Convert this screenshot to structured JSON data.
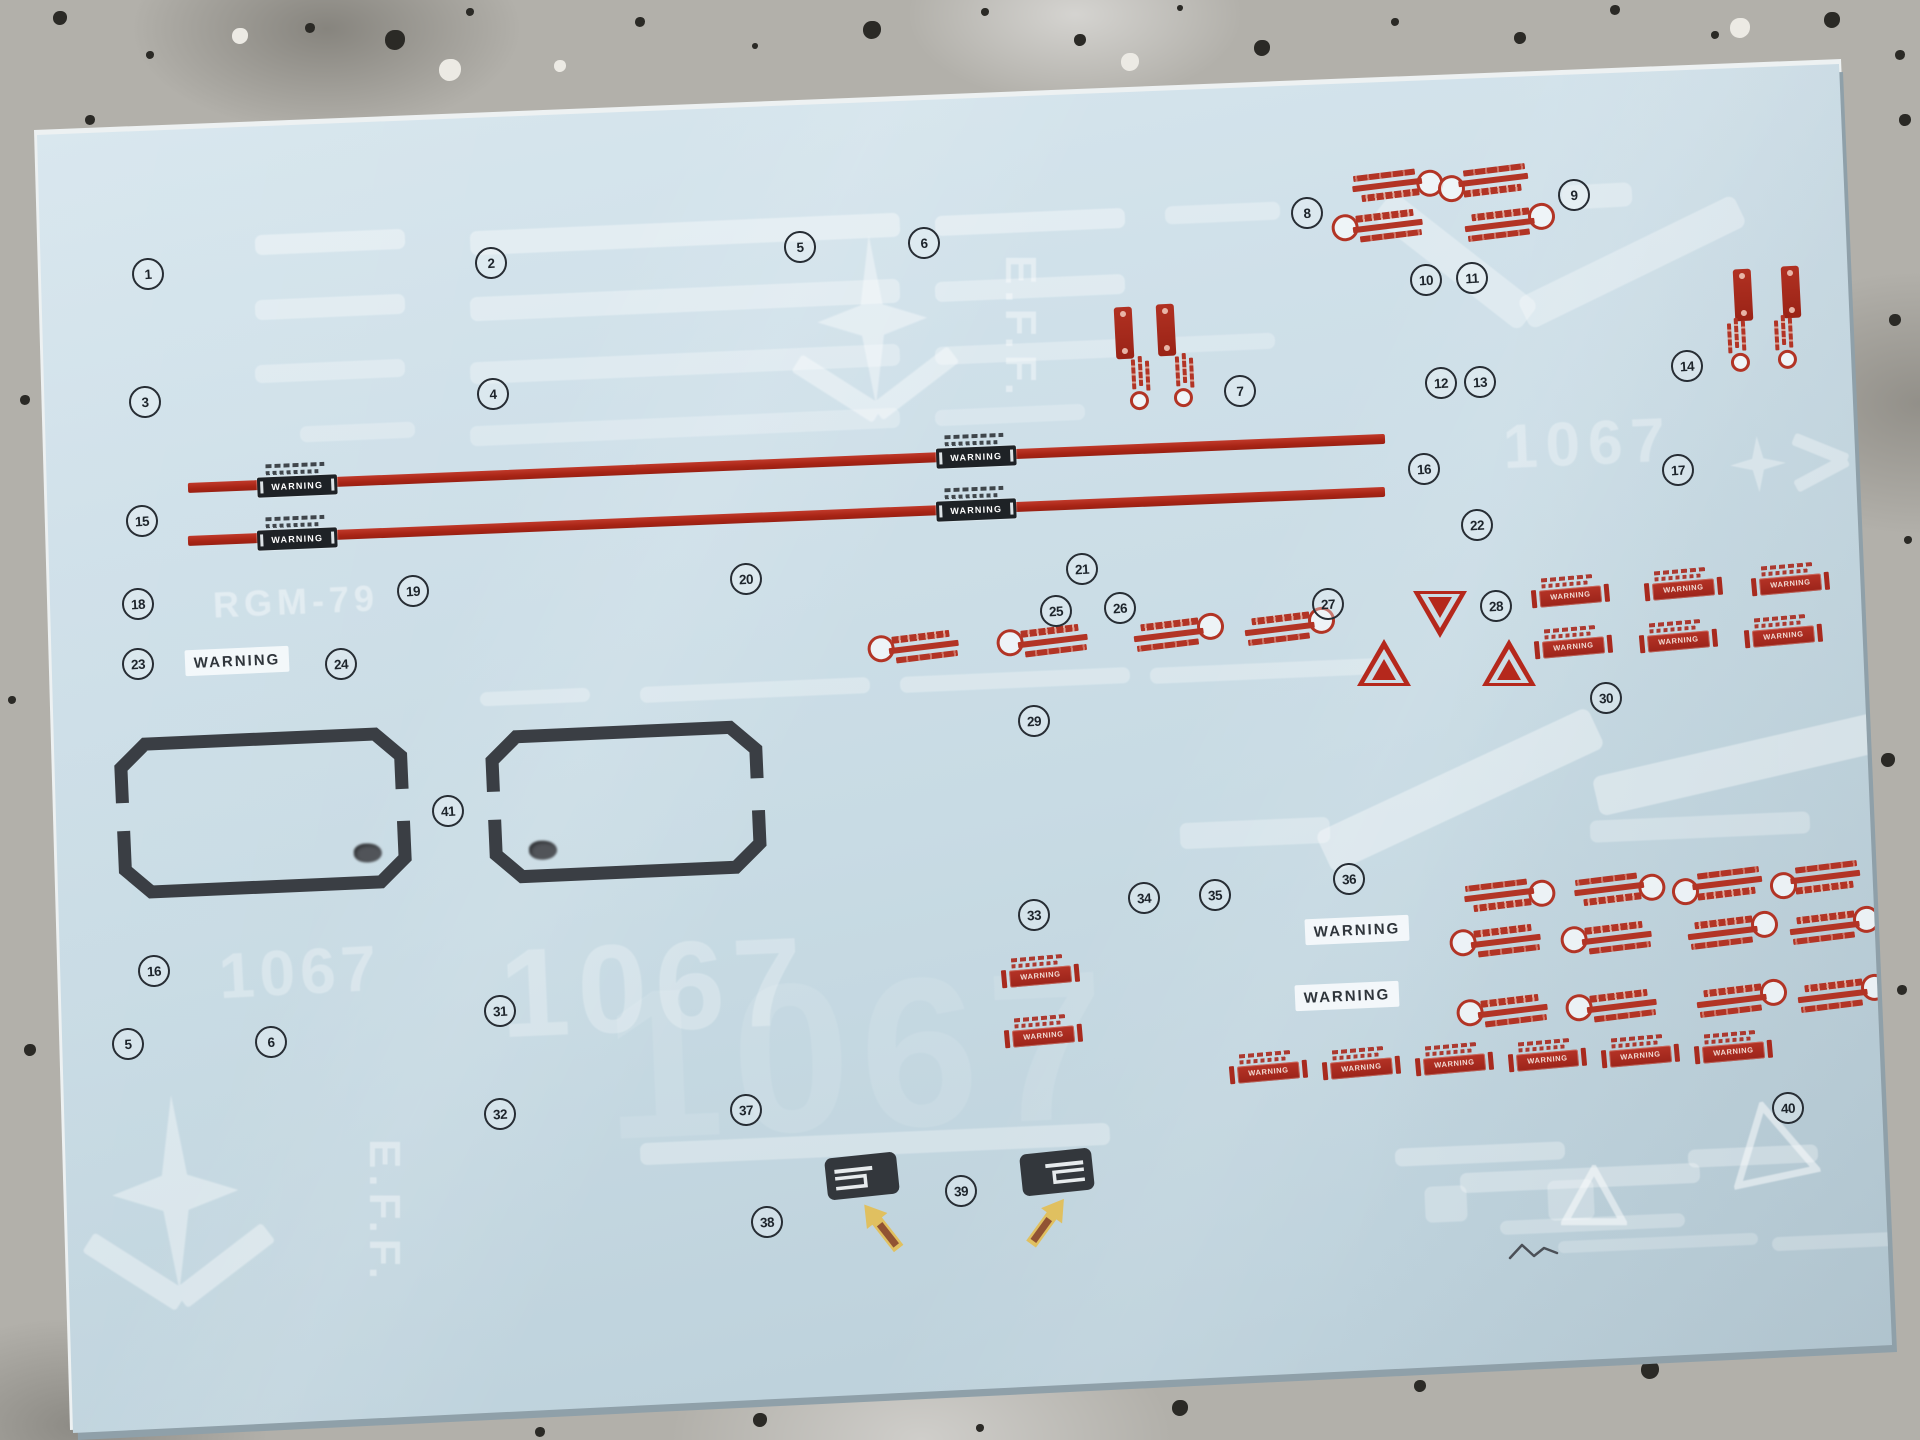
{
  "labels": {
    "warning": "WARNING",
    "eff": "E.F.F.",
    "model_code": "RGM-79",
    "unit_number": "1067"
  },
  "colors": {
    "sheet_blue": "#cbdde6",
    "decal_red": "#b23425",
    "decal_dark": "#33373c",
    "arrow_yellow": "#e2bf5a"
  },
  "markers": [
    {
      "n": "1",
      "x": 146,
      "y": 272
    },
    {
      "n": "2",
      "x": 489,
      "y": 261
    },
    {
      "n": "3",
      "x": 143,
      "y": 400
    },
    {
      "n": "4",
      "x": 491,
      "y": 392
    },
    {
      "n": "5",
      "x": 798,
      "y": 245
    },
    {
      "n": "6",
      "x": 922,
      "y": 241
    },
    {
      "n": "7",
      "x": 1238,
      "y": 389
    },
    {
      "n": "8",
      "x": 1305,
      "y": 211
    },
    {
      "n": "9",
      "x": 1572,
      "y": 193
    },
    {
      "n": "10",
      "x": 1424,
      "y": 278
    },
    {
      "n": "11",
      "x": 1470,
      "y": 276
    },
    {
      "n": "12",
      "x": 1439,
      "y": 381
    },
    {
      "n": "13",
      "x": 1478,
      "y": 380
    },
    {
      "n": "14",
      "x": 1685,
      "y": 364
    },
    {
      "n": "15",
      "x": 140,
      "y": 519
    },
    {
      "n": "16",
      "x": 1422,
      "y": 467
    },
    {
      "n": "17",
      "x": 1676,
      "y": 468
    },
    {
      "n": "18",
      "x": 136,
      "y": 602
    },
    {
      "n": "19",
      "x": 411,
      "y": 589
    },
    {
      "n": "20",
      "x": 744,
      "y": 577
    },
    {
      "n": "21",
      "x": 1080,
      "y": 567
    },
    {
      "n": "22",
      "x": 1475,
      "y": 523
    },
    {
      "n": "23",
      "x": 136,
      "y": 662
    },
    {
      "n": "24",
      "x": 339,
      "y": 662
    },
    {
      "n": "25",
      "x": 1054,
      "y": 609
    },
    {
      "n": "26",
      "x": 1118,
      "y": 606
    },
    {
      "n": "27",
      "x": 1326,
      "y": 602
    },
    {
      "n": "28",
      "x": 1494,
      "y": 604
    },
    {
      "n": "29",
      "x": 1032,
      "y": 719
    },
    {
      "n": "30",
      "x": 1604,
      "y": 696
    },
    {
      "n": "31",
      "x": 498,
      "y": 1009
    },
    {
      "n": "32",
      "x": 498,
      "y": 1112
    },
    {
      "n": "33",
      "x": 1032,
      "y": 913
    },
    {
      "n": "34",
      "x": 1142,
      "y": 896
    },
    {
      "n": "35",
      "x": 1213,
      "y": 893
    },
    {
      "n": "36",
      "x": 1347,
      "y": 877
    },
    {
      "n": "37",
      "x": 744,
      "y": 1108
    },
    {
      "n": "38",
      "x": 765,
      "y": 1220
    },
    {
      "n": "39",
      "x": 959,
      "y": 1189
    },
    {
      "n": "40",
      "x": 1786,
      "y": 1106
    },
    {
      "n": "41",
      "x": 446,
      "y": 809
    },
    {
      "n": "16",
      "x": 152,
      "y": 969
    },
    {
      "n": "5",
      "x": 126,
      "y": 1042
    },
    {
      "n": "6",
      "x": 269,
      "y": 1040
    }
  ],
  "red_stripes": [
    [
      188,
      488,
      1198
    ],
    [
      188,
      541,
      1198
    ]
  ],
  "stripe_warning_labels": [
    [
      297,
      481
    ],
    [
      976,
      452
    ],
    [
      297,
      534
    ],
    [
      976,
      505
    ]
  ],
  "white_warning_boxes": [
    [
      237,
      661
    ],
    [
      1357,
      930
    ],
    [
      1347,
      996
    ]
  ],
  "red_warning_boxes": [
    [
      1570,
      592
    ],
    [
      1683,
      585
    ],
    [
      1790,
      580
    ],
    [
      1573,
      643
    ],
    [
      1678,
      637
    ],
    [
      1783,
      632
    ],
    [
      1040,
      972
    ],
    [
      1043,
      1032
    ],
    [
      1268,
      1068
    ],
    [
      1361,
      1064
    ],
    [
      1454,
      1060
    ],
    [
      1547,
      1056
    ],
    [
      1640,
      1052
    ],
    [
      1733,
      1048
    ]
  ],
  "armor_lock_decals": [
    [
      924,
      649,
      "tl"
    ],
    [
      1053,
      643,
      "tl"
    ],
    [
      1169,
      637,
      "tr"
    ],
    [
      1280,
      631,
      "tr"
    ],
    [
      1387,
      183,
      "br"
    ],
    [
      1493,
      178,
      "bl"
    ],
    [
      1388,
      228,
      "tl"
    ],
    [
      1500,
      227,
      "tr"
    ],
    [
      1499,
      893,
      "br"
    ],
    [
      1609,
      887,
      "br"
    ],
    [
      1727,
      881,
      "bl"
    ],
    [
      1825,
      875,
      "bl"
    ],
    [
      1506,
      943,
      "tl"
    ],
    [
      1617,
      940,
      "tl"
    ],
    [
      1723,
      935,
      "tr"
    ],
    [
      1825,
      930,
      "tr"
    ],
    [
      1513,
      1013,
      "tl"
    ],
    [
      1622,
      1008,
      "tl"
    ],
    [
      1732,
      1003,
      "tr"
    ],
    [
      1833,
      998,
      "tr"
    ]
  ],
  "red_pill_decals": [
    [
      1124,
      333
    ],
    [
      1166,
      330
    ],
    [
      1743,
      295
    ],
    [
      1791,
      292
    ]
  ],
  "vertical_lock_decals": [
    [
      1141,
      382,
      0
    ],
    [
      1185,
      379,
      0
    ],
    [
      1737,
      344,
      1
    ],
    [
      1784,
      341,
      1
    ]
  ],
  "warning_triangles": [
    [
      1440,
      614,
      "down"
    ],
    [
      1384,
      662,
      "up"
    ],
    [
      1509,
      662,
      "up"
    ]
  ],
  "panel_frames": [
    [
      116,
      732,
      294,
      162,
      236,
      116
    ],
    [
      487,
      725,
      278,
      154,
      40,
      112
    ]
  ],
  "dark_tab_decals": [
    [
      862,
      1176,
      0
    ],
    [
      1057,
      1172,
      1
    ]
  ],
  "yellow_arrows": [
    [
      883,
      1226,
      -38
    ],
    [
      1046,
      1221,
      36
    ]
  ],
  "ghost_dashes": [
    [
      255,
      232,
      150,
      20,
      0.38
    ],
    [
      470,
      222,
      430,
      24,
      0.38
    ],
    [
      935,
      212,
      190,
      20,
      0.38
    ],
    [
      1165,
      204,
      115,
      18,
      0.3
    ],
    [
      255,
      297,
      150,
      20,
      0.34
    ],
    [
      470,
      288,
      430,
      24,
      0.34
    ],
    [
      935,
      278,
      190,
      20,
      0.34
    ],
    [
      255,
      362,
      150,
      18,
      0.3
    ],
    [
      470,
      353,
      430,
      22,
      0.3
    ],
    [
      935,
      343,
      190,
      18,
      0.3
    ],
    [
      1165,
      335,
      110,
      16,
      0.26
    ],
    [
      300,
      424,
      115,
      16,
      0.26
    ],
    [
      470,
      417,
      430,
      20,
      0.26
    ],
    [
      935,
      407,
      150,
      16,
      0.24
    ],
    [
      480,
      690,
      110,
      14,
      0.3
    ],
    [
      640,
      682,
      230,
      16,
      0.3
    ],
    [
      900,
      672,
      230,
      16,
      0.3
    ],
    [
      1150,
      663,
      230,
      16,
      0.3
    ],
    [
      640,
      1133,
      470,
      22,
      0.3
    ],
    [
      1395,
      1145,
      170,
      18,
      0.3
    ],
    [
      1460,
      1168,
      240,
      20,
      0.3
    ],
    [
      1500,
      1217,
      185,
      14,
      0.26
    ],
    [
      1558,
      1237,
      200,
      12,
      0.22
    ],
    [
      1688,
      1147,
      130,
      18,
      0.3
    ],
    [
      1772,
      1234,
      150,
      14,
      0.24
    ],
    [
      1425,
      1186,
      42,
      36,
      0.26
    ],
    [
      1548,
      1180,
      46,
      40,
      0.26
    ],
    [
      1180,
      820,
      150,
      26,
      0.3
    ],
    [
      1590,
      816,
      220,
      22,
      0.28
    ]
  ],
  "ghost_bands": [
    [
      1460,
      790,
      300,
      44,
      -25,
      0.38
    ],
    [
      1757,
      760,
      330,
      40,
      -13,
      0.38
    ],
    [
      1455,
      261,
      185,
      34,
      38,
      0.32
    ],
    [
      1632,
      262,
      240,
      34,
      -26,
      0.32
    ],
    [
      1597,
      196,
      70,
      24,
      -3,
      0.3
    ]
  ],
  "ghost_texts": [
    {
      "t": "E.F.F.",
      "x": 1020,
      "y": 328,
      "s": 44,
      "r": 90,
      "o": 0.42,
      "ls": 6
    },
    {
      "t": "E.F.F.",
      "x": 384,
      "y": 1212,
      "s": 44,
      "r": 90,
      "o": 0.4,
      "ls": 6
    },
    {
      "t": "RGM-79",
      "x": 296,
      "y": 602,
      "s": 36,
      "r": -2.5,
      "o": 0.42,
      "ls": 5
    },
    {
      "t": "1067",
      "x": 1588,
      "y": 444,
      "s": 62,
      "r": -2.5,
      "o": 0.32,
      "ls": 8
    },
    {
      "t": "1067",
      "x": 300,
      "y": 972,
      "s": 64,
      "r": -3,
      "o": 0.3,
      "ls": 5
    },
    {
      "t": "1067",
      "x": 655,
      "y": 988,
      "s": 125,
      "r": -2.5,
      "o": 0.26,
      "ls": 8
    },
    {
      "t": "1067",
      "x": 860,
      "y": 1055,
      "s": 212,
      "r": -2.5,
      "o": 0.1,
      "ls": 10
    }
  ],
  "ghost_emblems": [
    [
      873,
      335,
      1,
      0.4
    ],
    [
      176,
      1210,
      1.15,
      0.38
    ]
  ],
  "ghost_star_arrow": [
    1800,
    462,
    0.34
  ],
  "ghost_triangles": [
    [
      1594,
      1198,
      66,
      0
    ],
    [
      1770,
      1145,
      88,
      -12
    ]
  ],
  "pencil_squiggle": [
    1508,
    1240
  ],
  "background_speckles": [
    [
      60,
      18,
      7,
      "d"
    ],
    [
      150,
      55,
      4,
      "d"
    ],
    [
      240,
      36,
      8,
      "w"
    ],
    [
      310,
      28,
      5,
      "d"
    ],
    [
      395,
      40,
      10,
      "d"
    ],
    [
      470,
      12,
      4,
      "d"
    ],
    [
      450,
      70,
      11,
      "w"
    ],
    [
      560,
      66,
      6,
      "w"
    ],
    [
      640,
      22,
      5,
      "d"
    ],
    [
      755,
      46,
      3,
      "d"
    ],
    [
      872,
      30,
      9,
      "d"
    ],
    [
      985,
      12,
      4,
      "d"
    ],
    [
      1080,
      40,
      6,
      "d"
    ],
    [
      1130,
      62,
      9,
      "w"
    ],
    [
      1180,
      8,
      3,
      "d"
    ],
    [
      1262,
      48,
      8,
      "d"
    ],
    [
      1395,
      22,
      4,
      "d"
    ],
    [
      1520,
      38,
      6,
      "d"
    ],
    [
      1615,
      10,
      5,
      "d"
    ],
    [
      1715,
      35,
      4,
      "d"
    ],
    [
      1740,
      28,
      10,
      "w"
    ],
    [
      1832,
      20,
      8,
      "d"
    ],
    [
      1900,
      55,
      5,
      "d"
    ],
    [
      1895,
      320,
      6,
      "d"
    ],
    [
      1908,
      540,
      4,
      "d"
    ],
    [
      1888,
      760,
      7,
      "d"
    ],
    [
      1902,
      990,
      5,
      "d"
    ],
    [
      1878,
      1180,
      6,
      "d"
    ],
    [
      25,
      400,
      5,
      "d"
    ],
    [
      12,
      700,
      4,
      "d"
    ],
    [
      30,
      1050,
      6,
      "d"
    ],
    [
      120,
      1415,
      6,
      "d"
    ],
    [
      330,
      1402,
      9,
      "d"
    ],
    [
      540,
      1432,
      5,
      "d"
    ],
    [
      760,
      1420,
      7,
      "d"
    ],
    [
      980,
      1428,
      4,
      "d"
    ],
    [
      1180,
      1408,
      8,
      "d"
    ],
    [
      1420,
      1386,
      6,
      "d"
    ],
    [
      1650,
      1370,
      9,
      "d"
    ],
    [
      1850,
      1342,
      7,
      "d"
    ],
    [
      90,
      120,
      5,
      "d"
    ],
    [
      1905,
      120,
      6,
      "d"
    ]
  ]
}
